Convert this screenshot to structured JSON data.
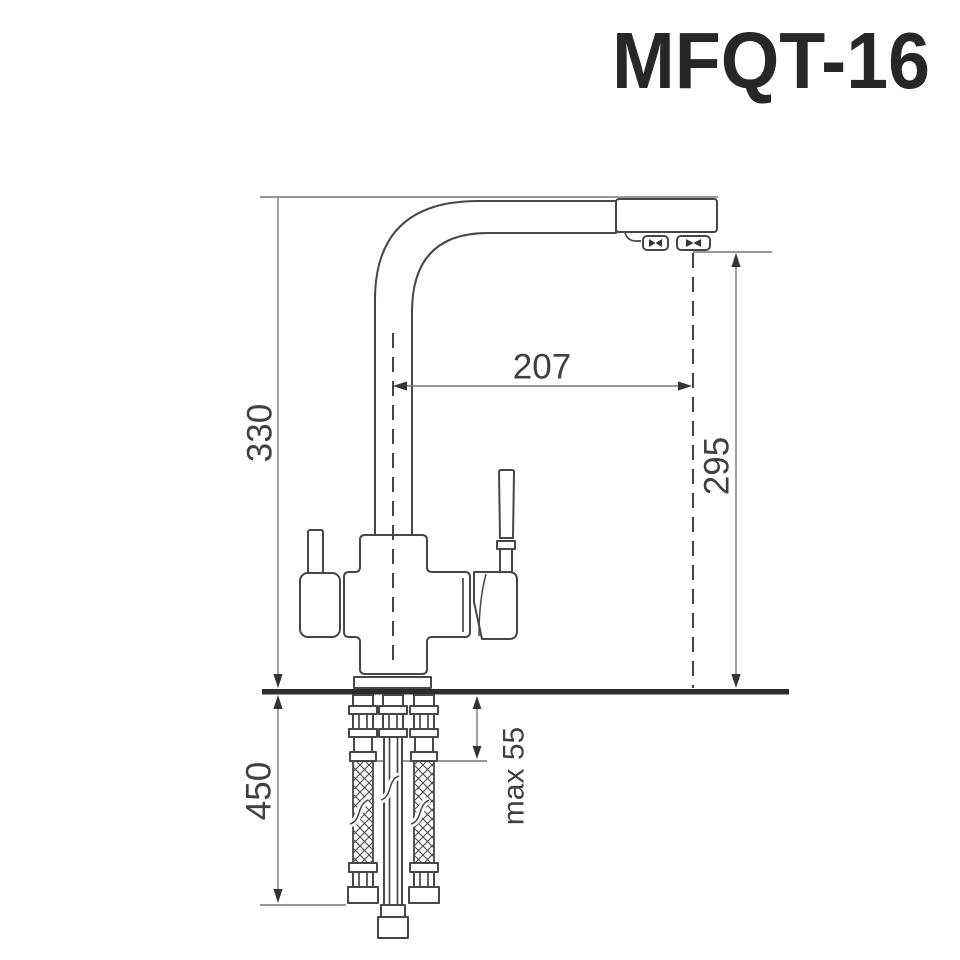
{
  "title": "MFQT-16",
  "dimensions": {
    "total_height": "330",
    "spout_reach": "207",
    "spout_height": "295",
    "hose_length": "450",
    "max_deck_thickness": "max 55"
  },
  "colors": {
    "line": "#46464b",
    "dim_line": "#77777c",
    "arrow": "#333338",
    "text": "#3f3f45",
    "counter": "#2c2c31",
    "title": "#26262b",
    "background": "#ffffff"
  }
}
